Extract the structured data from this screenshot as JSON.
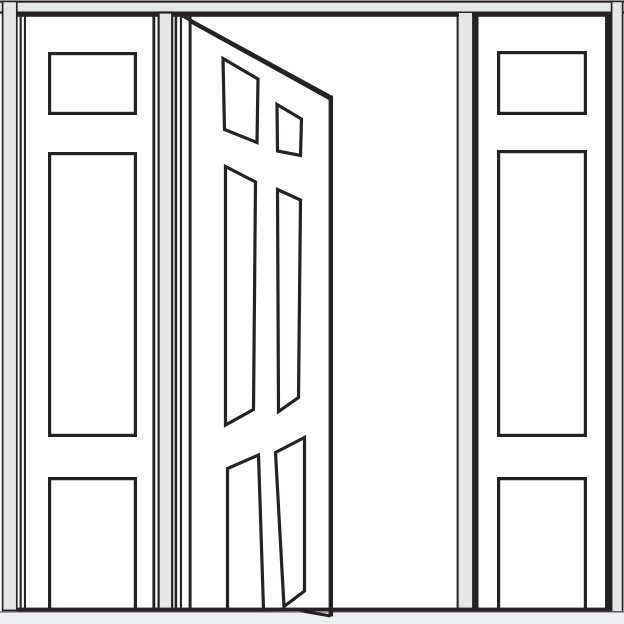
{
  "title": "Line drawing of an open six-panel entry door flanked by two sidelight panels",
  "colors": {
    "line": "#262224",
    "frame": "#e4e6e8",
    "sill": "#edf0f2",
    "surface": "#ffffff",
    "thin": "#595a5e"
  },
  "door": {
    "state": "open",
    "style": "six-panel",
    "visible_panels": 6,
    "hinge_side": "left"
  },
  "sidelights": {
    "count": 2,
    "panels_per_sidelight": 3,
    "panel_arrangement": "small top rectangle, tall middle rectangle, bottom rectangle open to sill"
  },
  "frame": {
    "head_jamb": "full-width gray bar at top",
    "side_jambs": "gray vertical strips at far left and far right",
    "mullions": "gray vertical strips separating door opening from each sidelight",
    "sill": "light gray strip across the bottom"
  }
}
